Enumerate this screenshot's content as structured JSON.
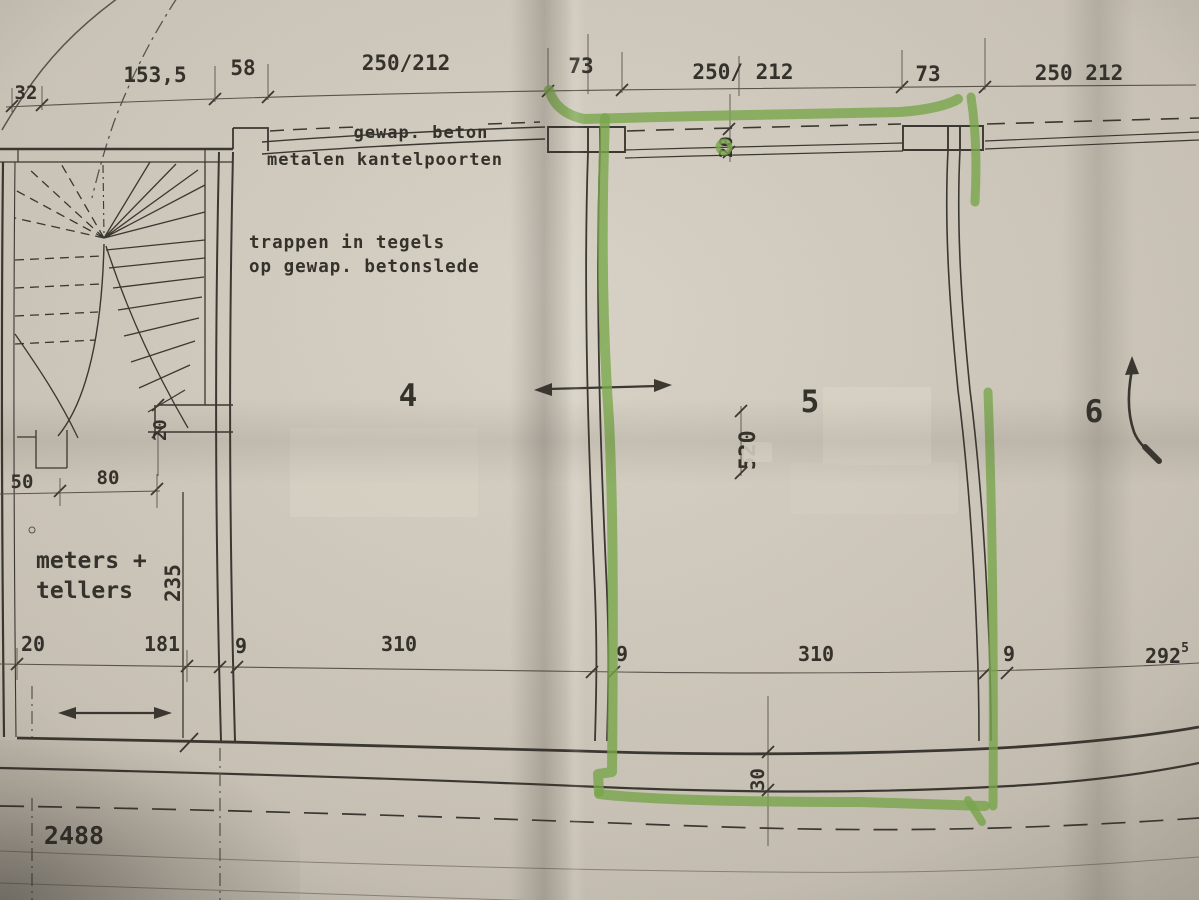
{
  "colors": {
    "paper": "#cfc8bb",
    "ink": "#3a3731",
    "highlighter": "#7aa94c"
  },
  "annotations": {
    "gewap_beton": "gewap. beton",
    "metalen_kantelpoorten": "metalen kantelpoorten",
    "trappen_1": "trappen in tegels",
    "trappen_2": "op gewap. betonslede",
    "meters_1": "meters +",
    "meters_2": "tellers"
  },
  "rooms": {
    "r4": "4",
    "r5": "5",
    "r6": "6"
  },
  "dims": {
    "top": [
      "32",
      "153,5",
      "58",
      "250/212",
      "73",
      "250/ 212",
      "73",
      "250 212"
    ],
    "bottom": [
      "20",
      "181",
      "9",
      "310",
      "9",
      "310",
      "9"
    ],
    "bottom_right": {
      "main": "292",
      "sup": "5"
    },
    "meters_top": [
      "50",
      "80"
    ],
    "gate_wall": "20",
    "garage_depth": "520",
    "stair_jog": "20",
    "meters_height": "235",
    "rear_wall": "30",
    "overall": "2488"
  }
}
